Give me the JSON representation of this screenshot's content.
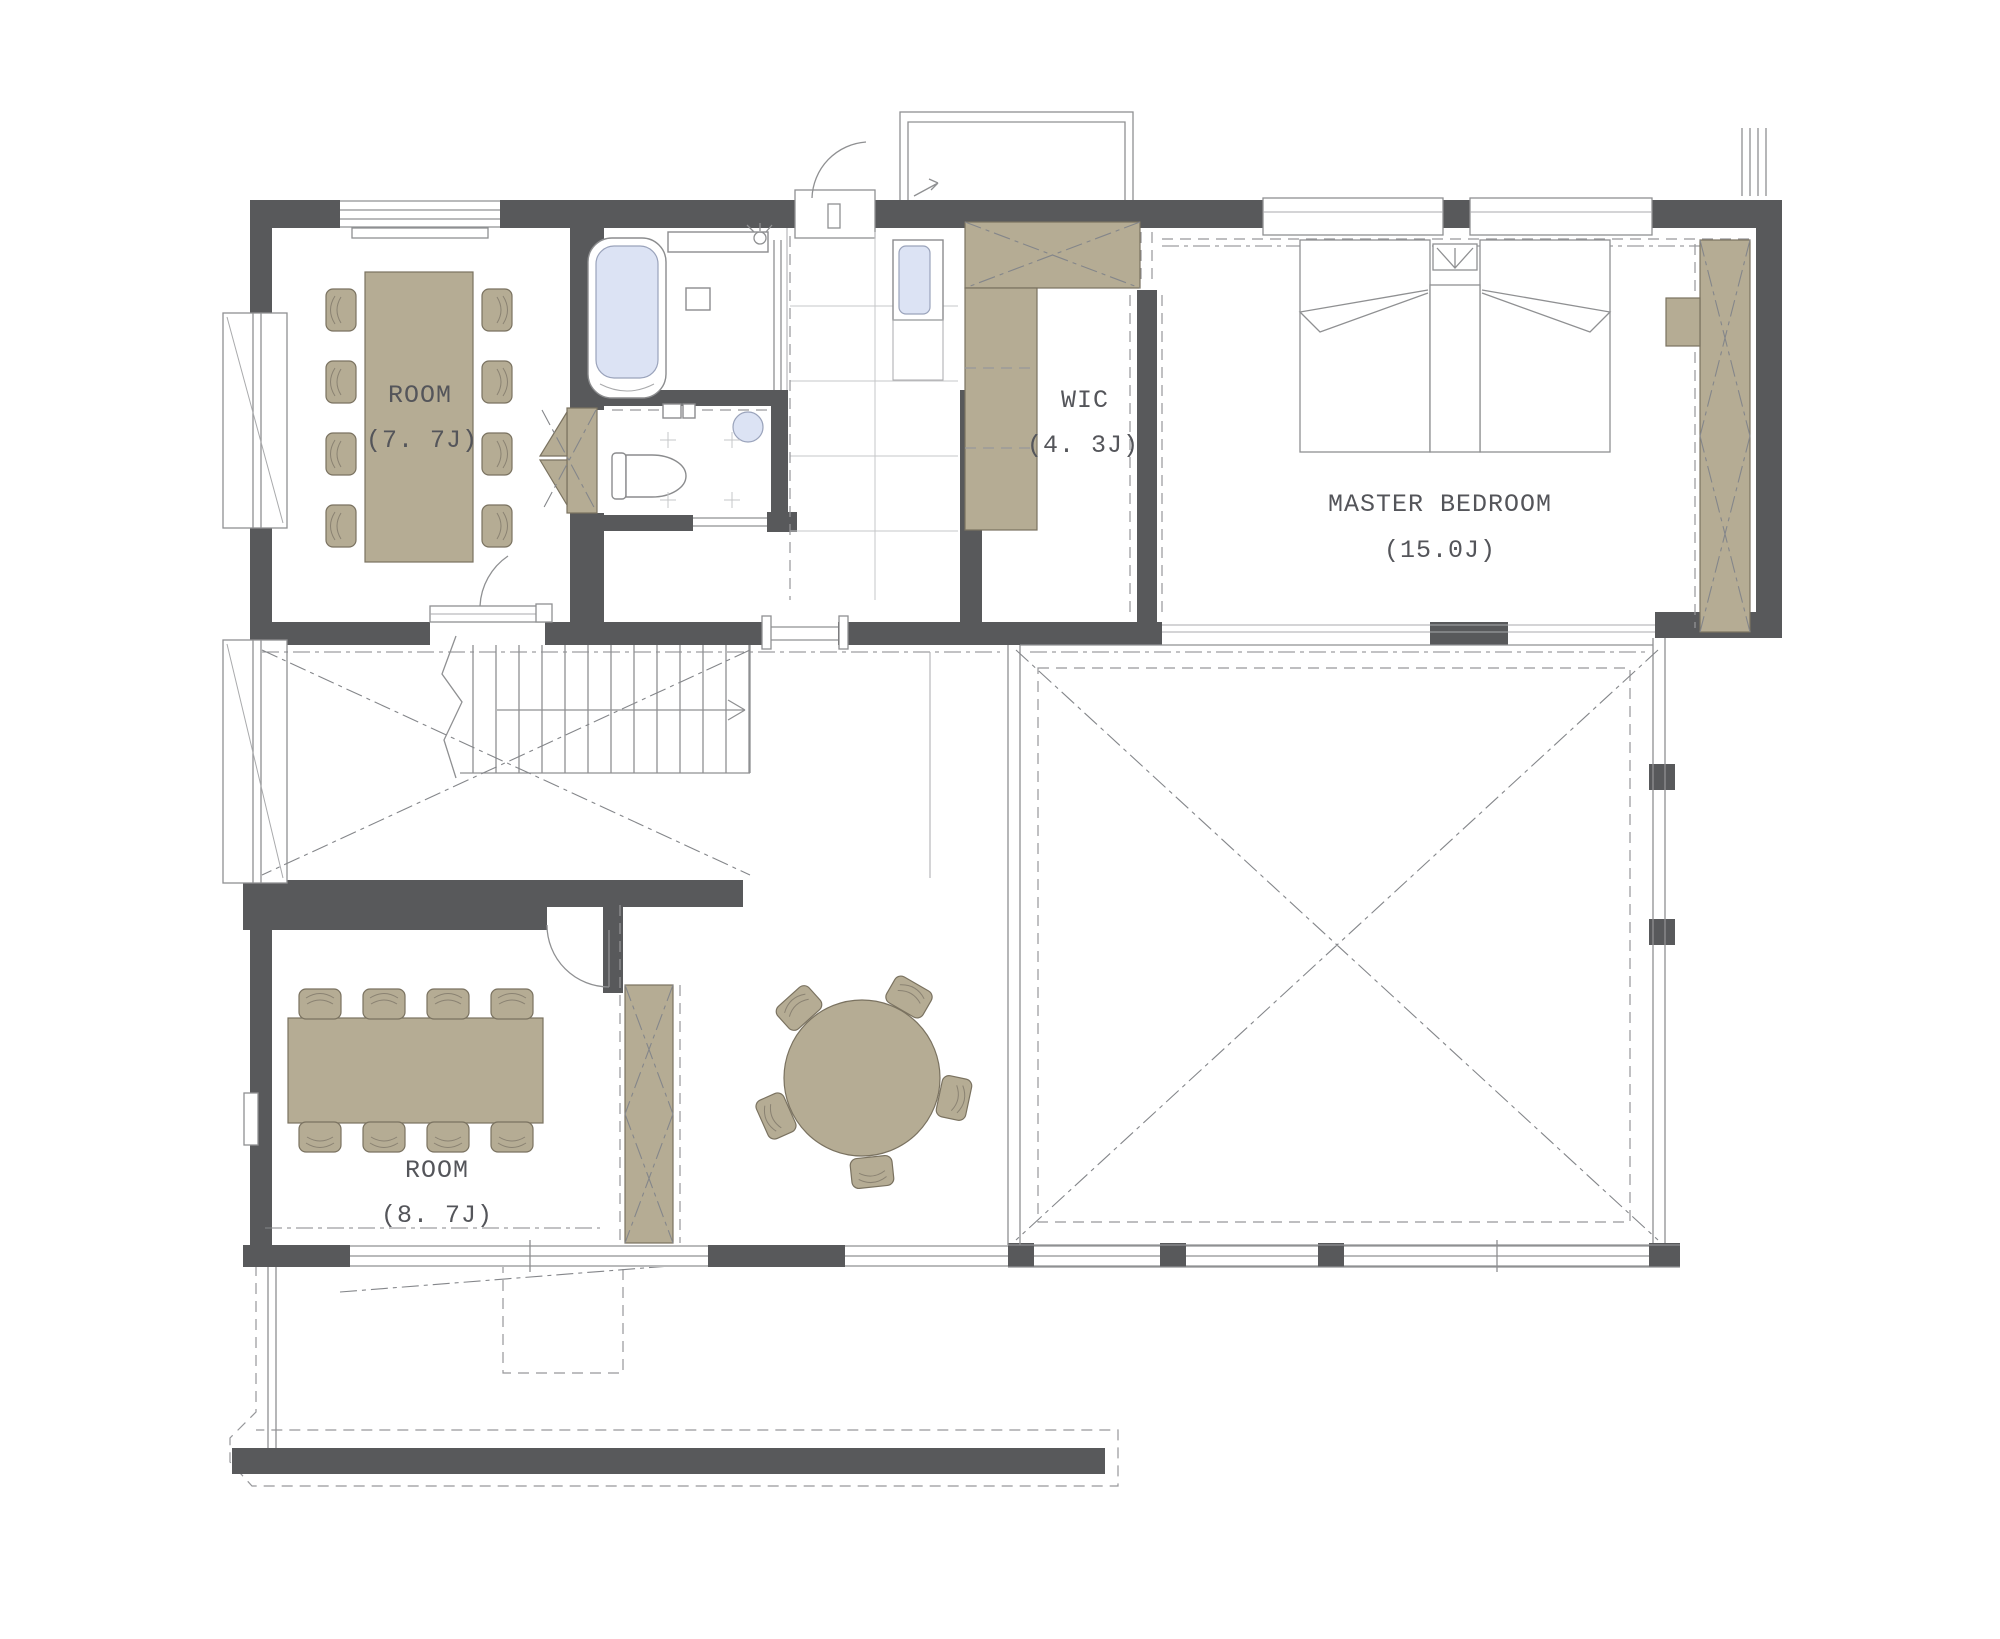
{
  "labels": {
    "room_77": {
      "name": "ROOM",
      "area": "(7. 7J)"
    },
    "wic": {
      "name": "WIC",
      "area": "(4. 3J)"
    },
    "master_bedroom": {
      "name": "MASTER BEDROOM",
      "area": "(15.0J)"
    },
    "room_87": {
      "name": "ROOM",
      "area": "(8. 7J)"
    }
  },
  "colors": {
    "wall": "#58595b",
    "furniture": "#b5ac94",
    "furniture_border": "#7a7260",
    "glass": "#dce3f4",
    "line": "#8f9092",
    "label_text": "#54555a"
  },
  "fixtures": {
    "room_77": [
      "dining-table",
      "chair-x8",
      "window-x2",
      "folding-closet"
    ],
    "bathroom": [
      "bathtub",
      "shower-head",
      "counter",
      "stool"
    ],
    "toilet_room": [
      "toilet",
      "washbasin",
      "faucet"
    ],
    "corridor": [
      "entrance-door",
      "tall-cabinet",
      "tile-floor"
    ],
    "wic": [
      "l-shaped-closet"
    ],
    "master_bedroom": [
      "single-bed-x2",
      "wall-lamp",
      "tall-closet",
      "nightstand",
      "window-x2"
    ],
    "stair_hall": [
      "staircase",
      "up-arrow",
      "open-void",
      "window"
    ],
    "room_87": [
      "dining-table",
      "chair-x8",
      "swing-door",
      "window",
      "closet"
    ],
    "free_space": [
      "round-table",
      "chair-x5"
    ],
    "atrium": [
      "open-void-x-mark",
      "railing-posts"
    ],
    "exterior": [
      "balcony-top",
      "balcony-bottom",
      "roof-outline-dashed",
      "hatch-marks"
    ]
  }
}
